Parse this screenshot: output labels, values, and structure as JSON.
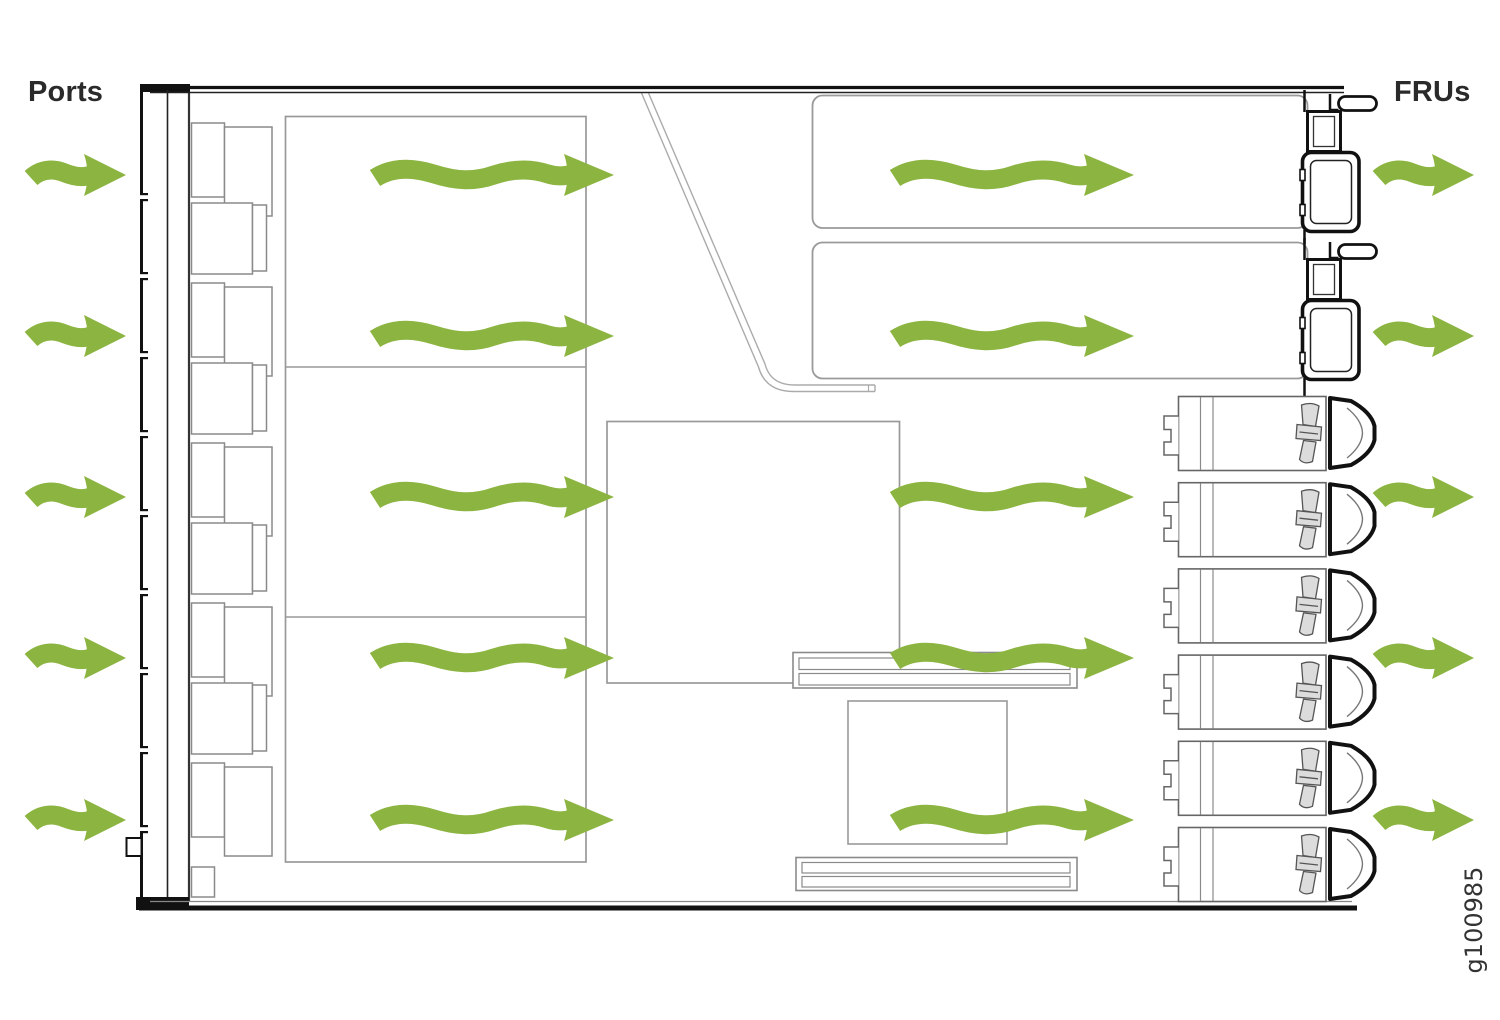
{
  "labels": {
    "ports": "Ports",
    "frus": "FRUs",
    "figure_id": "g100985"
  },
  "colors": {
    "airflow_green": "#8CB440",
    "chassis_black": "#111111",
    "component_gray": "#999999"
  },
  "airflow": {
    "direction": "left-to-right",
    "description": "Front-to-back airflow: cool air enters through the port side, passes over internal boards, and exhausts through the FRU (power supply and fan) side.",
    "row_centers_y": [
      175,
      336,
      497,
      658,
      820
    ],
    "columns": [
      {
        "name": "intake-before-ports",
        "variant": "short",
        "x": 30
      },
      {
        "name": "through-line-card",
        "variant": "long",
        "x": 374
      },
      {
        "name": "through-main-board",
        "variant": "long",
        "x": 894
      },
      {
        "name": "exhaust-after-frus",
        "variant": "short",
        "x": 1378
      }
    ]
  },
  "components": {
    "port_modules": 9,
    "power_supplies": 2,
    "fan_modules": 6
  }
}
